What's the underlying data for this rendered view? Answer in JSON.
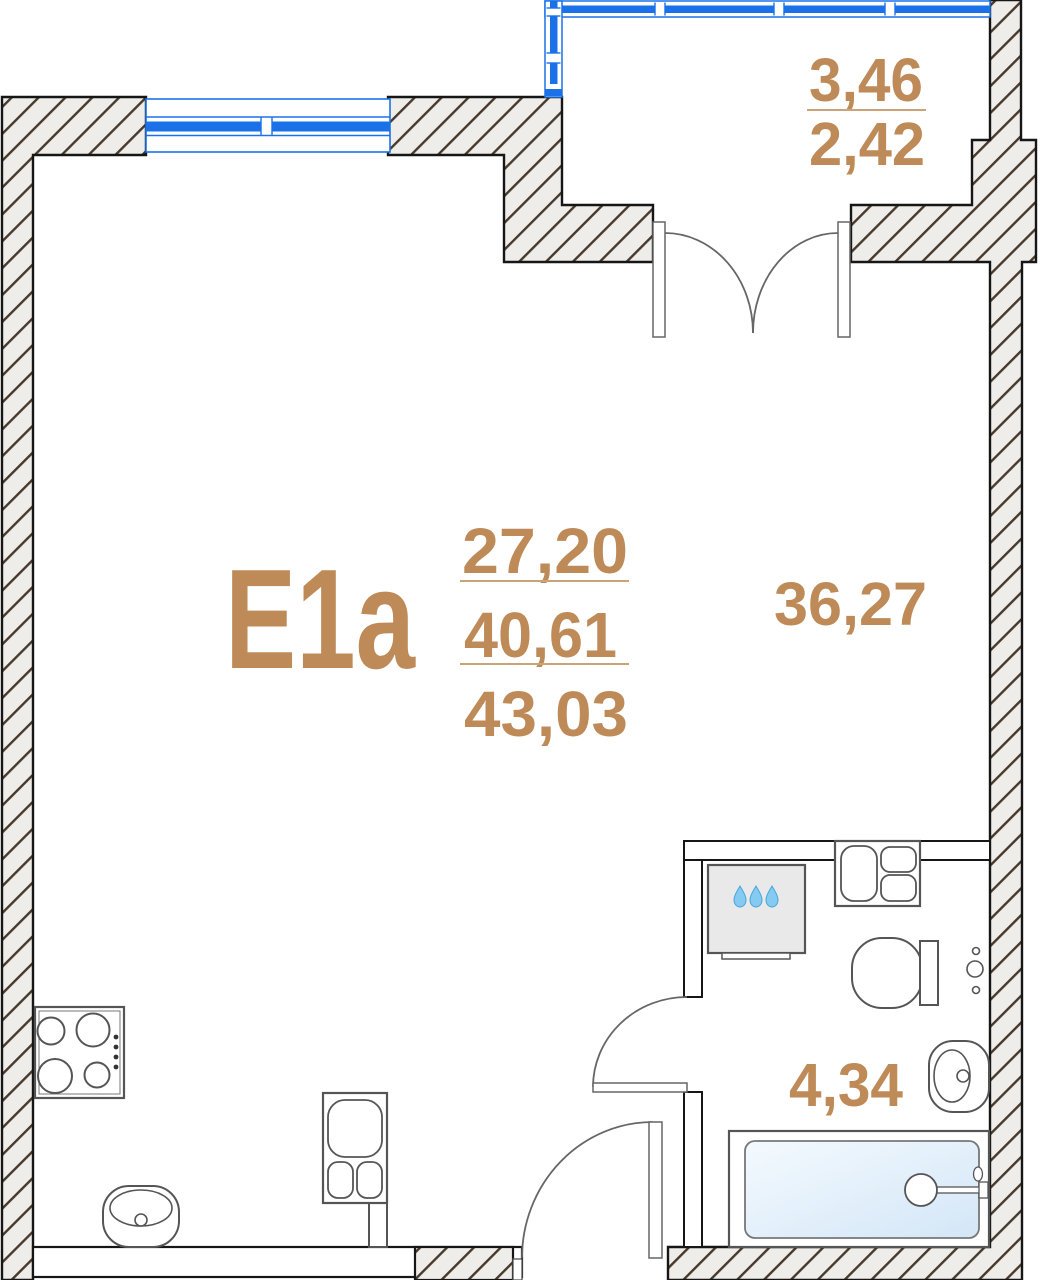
{
  "unit": {
    "label": "E1a",
    "area_living": "27,20",
    "area_total": "40,61",
    "area_overall": "43,03"
  },
  "rooms": {
    "main_room_area": "36,27",
    "bathroom_area": "4,34",
    "balcony_area_upper": "3,46",
    "balcony_area_lower": "2,42"
  },
  "colors": {
    "accent_text": "#BE8A58",
    "underline": "#C9A479",
    "window_blue": "#1B72E8",
    "wall_fill": "#EFEDE9",
    "wall_hatch_line": "#473A2D",
    "wall_outline": "#161616",
    "fixture_outline": "#555555",
    "appliance_fill": "#E9E9E9",
    "water_drop": "#85CBF1",
    "bathtub_fill": "#DCEBF8"
  }
}
